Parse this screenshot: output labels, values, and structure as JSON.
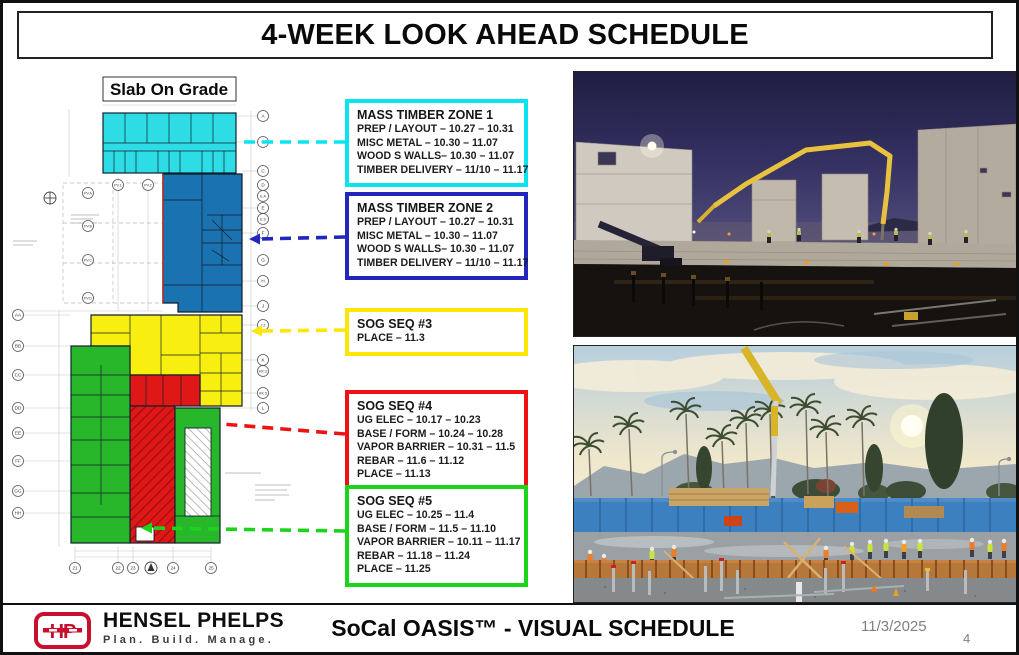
{
  "title": "4-WEEK LOOK AHEAD SCHEDULE",
  "plan": {
    "label": "Slab On Grade",
    "zones": {
      "zone1": {
        "name": "Mass Timber Zone 1",
        "color": "#2edce6"
      },
      "zone2": {
        "name": "Mass Timber Zone 2",
        "color": "#1a72b0"
      },
      "zone3": {
        "name": "SOG Seq #3",
        "color": "#f8ee10"
      },
      "zone4": {
        "name": "SOG Seq #4",
        "color": "#e01717"
      },
      "zone5": {
        "name": "SOG Seq #5",
        "color": "#28b62a"
      }
    },
    "grid_bubbles_right": [
      "A",
      "B",
      "C",
      "D",
      "E.A",
      "E",
      "E.S",
      "F",
      "G",
      "H",
      "J",
      "J.2",
      "K",
      "KK.3",
      "KK.5",
      "L"
    ],
    "grid_bubbles_left_pv": [
      "PV.A",
      "PV.B",
      "PV.C",
      "PV.D"
    ],
    "grid_bubbles_pv_top": [
      "PV.1",
      "PV.2"
    ],
    "grid_bubbles_far_left": [
      "AA",
      "BB",
      "CC",
      "DD",
      "EE",
      "FF",
      "GG",
      "HH"
    ],
    "grid_bubbles_bottom": [
      "21",
      "22",
      "23",
      "24",
      "25"
    ]
  },
  "callouts": [
    {
      "id": "mass-timber-zone-1",
      "color": "#0be4f0",
      "title": "MASS TIMBER ZONE 1",
      "lines": [
        "PREP / LAYOUT – 10.27 – 10.31",
        "MISC METAL – 10.30 – 11.07",
        "WOOD S WALLS– 10.30 – 11.07",
        "TIMBER DELIVERY – 11/10 – 11.17"
      ]
    },
    {
      "id": "mass-timber-zone-2",
      "color": "#2226bc",
      "title": "MASS TIMBER ZONE 2",
      "lines": [
        "PREP / LAYOUT – 10.27 – 10.31",
        "MISC METAL – 10.30 – 11.07",
        "WOOD S WALLS– 10.30 – 11.07",
        "TIMBER DELIVERY – 11/10 – 11.17"
      ]
    },
    {
      "id": "sog-seq-3",
      "color": "#ffe606",
      "title": "SOG SEQ #3",
      "lines": [
        "PLACE – 11.3"
      ]
    },
    {
      "id": "sog-seq-4",
      "color": "#f01212",
      "title": "SOG SEQ #4",
      "lines": [
        "UG ELEC – 10.17 – 10.23",
        "BASE / FORM – 10.24 – 10.28",
        "VAPOR BARRIER – 10.31 – 11.5",
        "REBAR – 11.6 – 11.12",
        "PLACE – 11.13"
      ]
    },
    {
      "id": "sog-seq-5",
      "color": "#1bd41b",
      "title": "SOG SEQ #5",
      "lines": [
        "UG ELEC – 10.25 – 11.4",
        "BASE / FORM – 11.5 – 11.10",
        "VAPOR BARRIER – 10.11 – 11.17",
        "REBAR – 11.18 – 11.24",
        "PLACE – 11.25"
      ]
    }
  ],
  "photos": [
    {
      "id": "photo-night-pour",
      "label": "Night concrete pour with tilt-up panels and pump boom"
    },
    {
      "id": "photo-day-slab",
      "label": "Daytime slab formwork crew with palm trees"
    }
  ],
  "footer": {
    "logo_text": "HP",
    "company": "HENSEL PHELPS",
    "tagline": "Plan. Build. Manage.",
    "project": "SoCal OASIS™ - VISUAL SCHEDULE",
    "date": "11/3/2025",
    "page": "4"
  }
}
